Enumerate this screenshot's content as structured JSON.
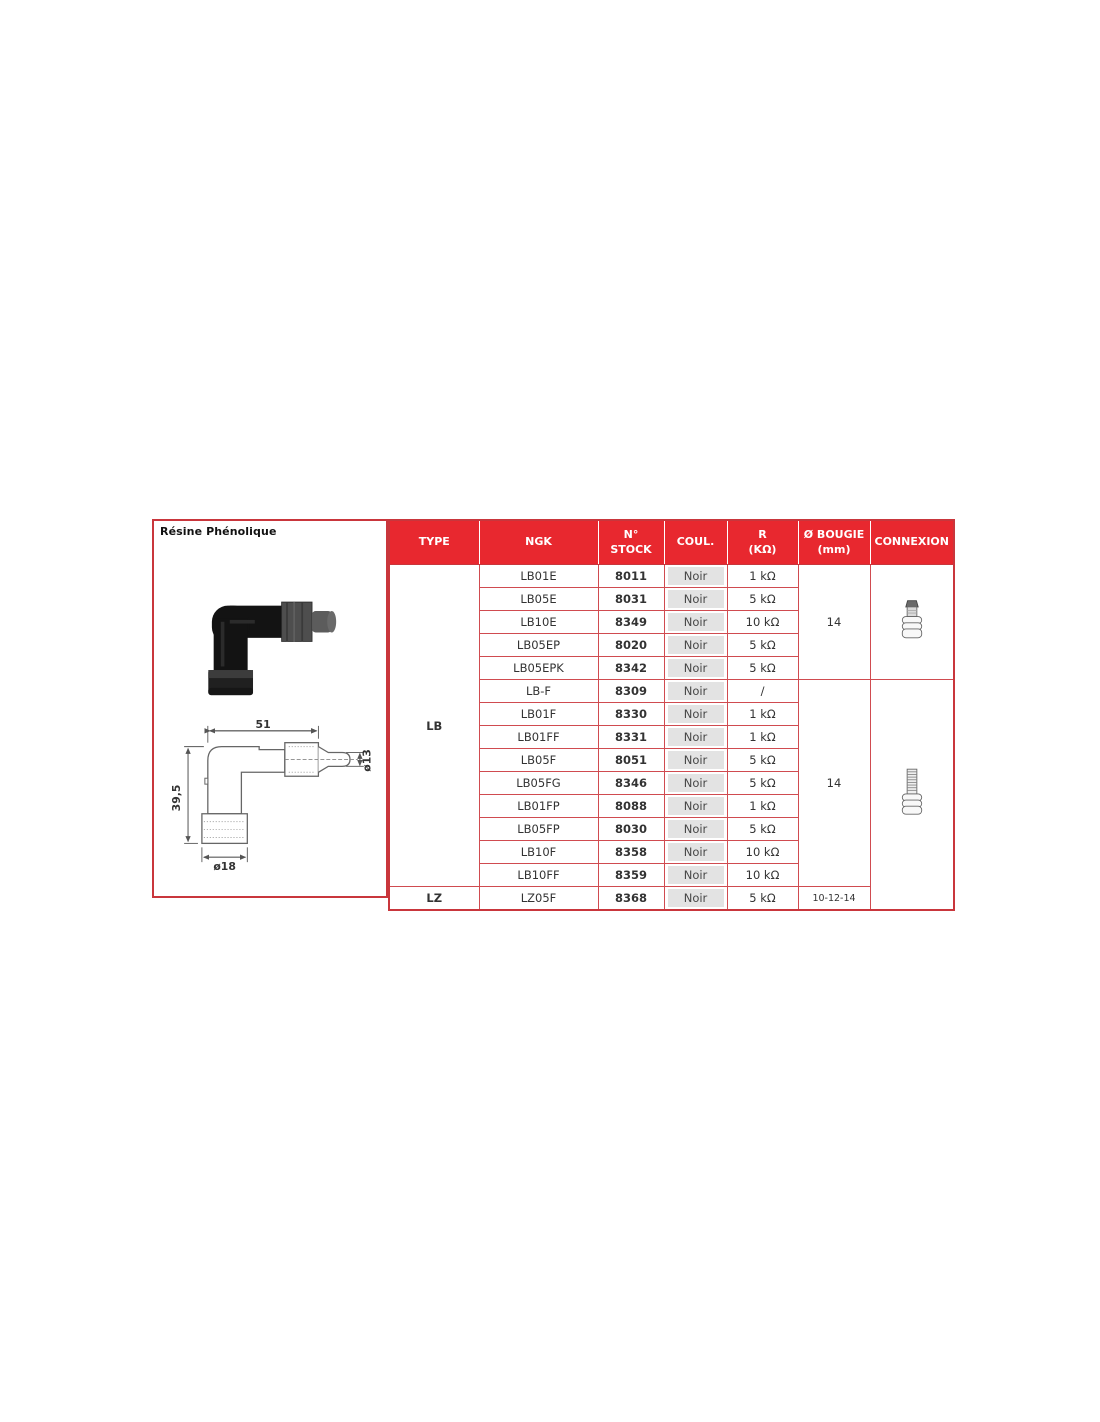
{
  "panel": {
    "title": "Résine Phénolique",
    "drawing": {
      "dim_length": "51",
      "dim_height": "39,5",
      "dim_tip": "ø13",
      "dim_base": "ø18"
    }
  },
  "table": {
    "headers": {
      "type": "TYPE",
      "ngk": "NGK",
      "stock1": "N°",
      "stock2": "STOCK",
      "coul": "COUL.",
      "r1": "R",
      "r2": "(KΩ)",
      "bougie1": "Ø BOUGIE",
      "bougie2": "(mm)",
      "connexion": "CONNEXION"
    },
    "types": {
      "lb": "LB",
      "lz": "LZ"
    },
    "bougie": {
      "group1": "14",
      "group2": "14",
      "group3": "10-12-14"
    },
    "connexion_icons": {
      "group1": "terminal-nut-icon",
      "group2": "threaded-stud-icon"
    },
    "colors": {
      "header_bg": "#e8282f",
      "border": "#d04b50",
      "noir_bg": "#e3e3e3"
    },
    "rows": [
      {
        "ngk": "LB01E",
        "stock": "8011",
        "coul": "Noir",
        "r": "1 kΩ"
      },
      {
        "ngk": "LB05E",
        "stock": "8031",
        "coul": "Noir",
        "r": "5 kΩ"
      },
      {
        "ngk": "LB10E",
        "stock": "8349",
        "coul": "Noir",
        "r": "10 kΩ"
      },
      {
        "ngk": "LB05EP",
        "stock": "8020",
        "coul": "Noir",
        "r": "5 kΩ"
      },
      {
        "ngk": "LB05EPK",
        "stock": "8342",
        "coul": "Noir",
        "r": "5 kΩ"
      },
      {
        "ngk": "LB-F",
        "stock": "8309",
        "coul": "Noir",
        "r": "/"
      },
      {
        "ngk": "LB01F",
        "stock": "8330",
        "coul": "Noir",
        "r": "1 kΩ"
      },
      {
        "ngk": "LB01FF",
        "stock": "8331",
        "coul": "Noir",
        "r": "1 kΩ"
      },
      {
        "ngk": "LB05F",
        "stock": "8051",
        "coul": "Noir",
        "r": "5 kΩ"
      },
      {
        "ngk": "LB05FG",
        "stock": "8346",
        "coul": "Noir",
        "r": "5 kΩ"
      },
      {
        "ngk": "LB01FP",
        "stock": "8088",
        "coul": "Noir",
        "r": "1 kΩ"
      },
      {
        "ngk": "LB05FP",
        "stock": "8030",
        "coul": "Noir",
        "r": "5 kΩ"
      },
      {
        "ngk": "LB10F",
        "stock": "8358",
        "coul": "Noir",
        "r": "10 kΩ"
      },
      {
        "ngk": "LB10FF",
        "stock": "8359",
        "coul": "Noir",
        "r": "10 kΩ"
      },
      {
        "ngk": "LZ05F",
        "stock": "8368",
        "coul": "Noir",
        "r": "5 kΩ"
      }
    ]
  }
}
